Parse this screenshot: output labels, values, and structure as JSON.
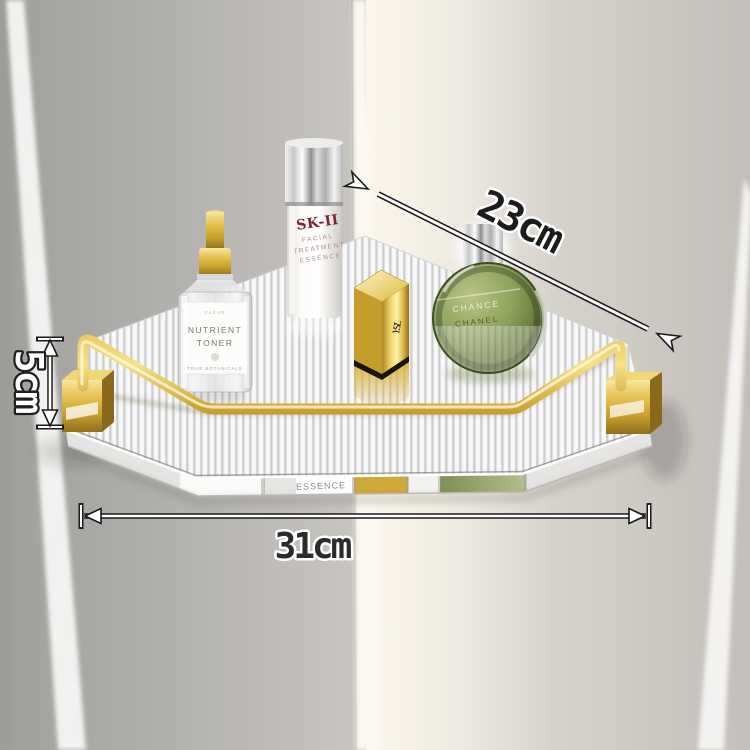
{
  "annotations": {
    "diagonal_depth": "23cm",
    "height": "5cm",
    "width": "31cm"
  },
  "products": {
    "toner_bottle": {
      "label_top": "CLEAR",
      "name_line1": "NUTRIENT",
      "name_line2": "TONER",
      "label_bottom": "TRUE BOTANICALS"
    },
    "essence_bottle": {
      "brand": "SK-II",
      "desc_line1": "FACIAL",
      "desc_line2": "TREATMENT",
      "desc_line3": "ESSENCE"
    },
    "lipstick": {
      "monogram": "YSL"
    },
    "perfume": {
      "name": "CHANCE",
      "brand": "CHANEL"
    }
  },
  "shelf": {
    "edge_reflection_text": "ESSENCE"
  },
  "colors": {
    "gold": "#cfa939",
    "gold_light": "#f3dd84",
    "gold_dark": "#8a691c",
    "brand_red": "#7d2230",
    "perfume_green": "#8fa061",
    "wall_left": "#b0aeab",
    "wall_right": "#d8d4ce",
    "corner_glow": "#faf5ea"
  }
}
